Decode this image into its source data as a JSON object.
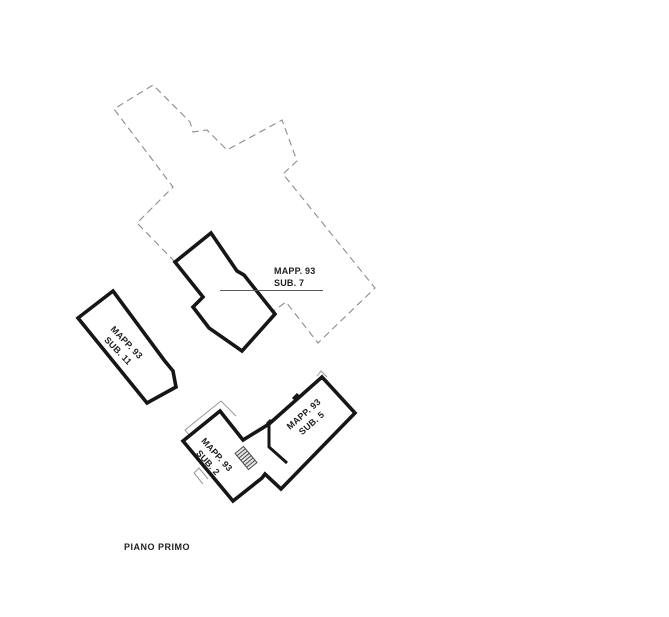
{
  "labels": {
    "sub7": {
      "line1": "MAPP. 93",
      "line2": "SUB. 7"
    },
    "sub11": {
      "line1": "MAPP. 93",
      "line2": "SUB. 11"
    },
    "sub2": {
      "line1": "MAPP. 93",
      "line2": "SUB. 2"
    },
    "sub5": {
      "line1": "MAPP. 93",
      "line2": "SUB. 5"
    },
    "floor": {
      "text": "PIANO PRIMO"
    }
  },
  "colors": {
    "background": "#ffffff",
    "solid_outline": "#161616",
    "dashed_outline": "#8c8c8c",
    "leader_line": "#5a5a5a",
    "text": "#1f1f1f",
    "stair_fill": "#e6e6e6"
  }
}
